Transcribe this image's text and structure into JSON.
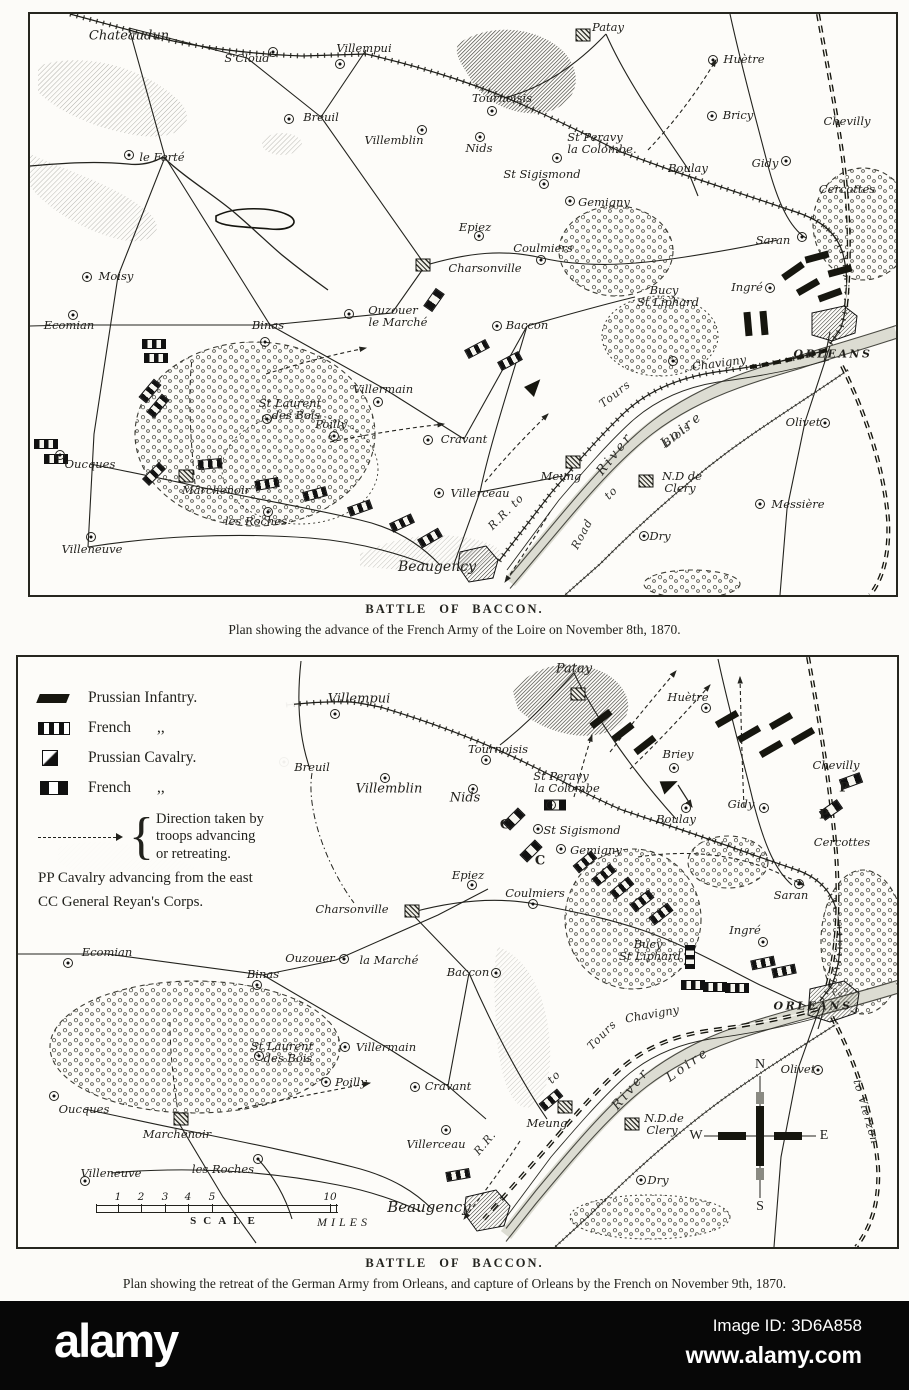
{
  "map1": {
    "caption_title": "BATTLE OF BACCON.",
    "caption_sub": "Plan showing the advance of the French Army of the Loire on November 8th, 1870.",
    "labels": [
      {
        "t": "Chateaudun",
        "x": 99,
        "y": 22,
        "s": 13
      },
      {
        "t": "S'Cloud",
        "x": 217,
        "y": 44,
        "d": [
          26,
          -6
        ]
      },
      {
        "t": "Villempui",
        "x": 334,
        "y": 34,
        "d": [
          -24,
          16
        ]
      },
      {
        "t": "Tournoisis",
        "x": 472,
        "y": 84,
        "d": [
          -10,
          13
        ]
      },
      {
        "t": "Breuil",
        "x": 291,
        "y": 103,
        "d": [
          -32,
          2
        ]
      },
      {
        "t": "Villemblin",
        "x": 364,
        "y": 126,
        "d": [
          28,
          -10
        ]
      },
      {
        "t": "Nids",
        "x": 449,
        "y": 134,
        "d": [
          1,
          -11
        ]
      },
      {
        "t": "St Peravy",
        "x": 565,
        "y": 123
      },
      {
        "t": "la Colombe.",
        "x": 572,
        "y": 135,
        "d": [
          -45,
          9
        ]
      },
      {
        "t": "St Sigismond",
        "x": 512,
        "y": 160,
        "d": [
          2,
          10
        ]
      },
      {
        "t": "Patay",
        "x": 578,
        "y": 13,
        "q": [
          -25,
          8
        ]
      },
      {
        "t": "Huètre",
        "x": 714,
        "y": 45,
        "d": [
          -31,
          1
        ]
      },
      {
        "t": "Bricy",
        "x": 708,
        "y": 101,
        "d": [
          -26,
          1
        ]
      },
      {
        "t": "Boulay",
        "x": 658,
        "y": 154
      },
      {
        "t": "Gidy",
        "x": 735,
        "y": 149,
        "d": [
          21,
          -2
        ]
      },
      {
        "t": "Chevilly",
        "x": 817,
        "y": 107
      },
      {
        "t": "Cercottes",
        "x": 817,
        "y": 175
      },
      {
        "t": "Saran",
        "x": 743,
        "y": 226,
        "d": [
          29,
          -3
        ]
      },
      {
        "t": "Ingré",
        "x": 717,
        "y": 273,
        "d": [
          23,
          1
        ]
      },
      {
        "t": "Gemigny",
        "x": 574,
        "y": 188,
        "d": [
          -34,
          -1
        ]
      },
      {
        "t": "Epiez",
        "x": 445,
        "y": 213,
        "d": [
          4,
          9
        ]
      },
      {
        "t": "Coulmiers",
        "x": 513,
        "y": 234,
        "d": [
          -2,
          12
        ]
      },
      {
        "t": "Charsonville",
        "x": 455,
        "y": 254,
        "q": [
          -62,
          -3
        ]
      },
      {
        "t": "Ouzouer",
        "x": 363,
        "y": 296
      },
      {
        "t": "le Marché",
        "x": 368,
        "y": 308,
        "d": [
          -49,
          -8
        ]
      },
      {
        "t": "Baccon",
        "x": 497,
        "y": 311,
        "d": [
          -30,
          1
        ]
      },
      {
        "t": "Bucy",
        "x": 634,
        "y": 276
      },
      {
        "t": "St Liphard",
        "x": 638,
        "y": 288
      },
      {
        "t": "Binas",
        "x": 238,
        "y": 311,
        "d": [
          -3,
          17
        ]
      },
      {
        "t": "Ecomian",
        "x": 39,
        "y": 311,
        "d": [
          4,
          -10
        ]
      },
      {
        "t": "Moisy",
        "x": 86,
        "y": 262,
        "d": [
          -29,
          1
        ]
      },
      {
        "t": "le Ferté",
        "x": 132,
        "y": 143,
        "d": [
          -33,
          -2
        ]
      },
      {
        "t": "Villermain",
        "x": 353,
        "y": 375,
        "d": [
          -5,
          13
        ]
      },
      {
        "t": "St Laurent",
        "x": 260,
        "y": 389
      },
      {
        "t": "des Bois",
        "x": 266,
        "y": 401,
        "d": [
          -29,
          4
        ]
      },
      {
        "t": "Poilly",
        "x": 301,
        "y": 410,
        "d": [
          3,
          12
        ]
      },
      {
        "t": "Cravant",
        "x": 434,
        "y": 425,
        "d": [
          -36,
          1
        ]
      },
      {
        "t": "Oucques",
        "x": 60,
        "y": 450,
        "d": [
          -30,
          -9
        ]
      },
      {
        "t": "Marchenoir",
        "x": 186,
        "y": 476,
        "q": [
          -30,
          -14
        ]
      },
      {
        "t": "les Roches",
        "x": 226,
        "y": 507,
        "d": [
          12,
          -9
        ]
      },
      {
        "t": "Villeneuve",
        "x": 62,
        "y": 535,
        "d": [
          -1,
          -12
        ]
      },
      {
        "t": "Beaugency",
        "x": 407,
        "y": 553,
        "s": 14
      },
      {
        "t": "Villerceau",
        "x": 450,
        "y": 479,
        "d": [
          -41,
          0
        ]
      },
      {
        "t": "Meung",
        "x": 531,
        "y": 462,
        "q": [
          12,
          -14
        ]
      },
      {
        "t": "N.D de",
        "x": 652,
        "y": 462,
        "q": [
          -36,
          5
        ]
      },
      {
        "t": "Clery",
        "x": 650,
        "y": 474
      },
      {
        "t": "Messière",
        "x": 768,
        "y": 490,
        "d": [
          -38,
          0
        ]
      },
      {
        "t": "Dry",
        "x": 630,
        "y": 522,
        "d": [
          -16,
          0
        ]
      },
      {
        "t": "Olivet",
        "x": 773,
        "y": 408,
        "d": [
          22,
          1
        ]
      },
      {
        "t": "ORLEANS",
        "x": 803,
        "y": 340,
        "c": "caps"
      },
      {
        "t": "Chavigny",
        "x": 689,
        "y": 349,
        "r": -8,
        "d": [
          -46,
          -2
        ]
      },
      {
        "t": "River",
        "x": 585,
        "y": 440,
        "r": -52,
        "c": "riv"
      },
      {
        "t": "Loire",
        "x": 652,
        "y": 416,
        "r": -38,
        "c": "riv"
      },
      {
        "t": "Tours",
        "x": 585,
        "y": 380,
        "r": -38,
        "c": "riv2"
      },
      {
        "t": "R.R. to",
        "x": 476,
        "y": 498,
        "r": -45,
        "c": "riv2"
      },
      {
        "t": "Road",
        "x": 552,
        "y": 520,
        "r": -62,
        "c": "riv2"
      },
      {
        "t": "to",
        "x": 581,
        "y": 479,
        "r": -45,
        "c": "riv2"
      },
      {
        "t": "Blois",
        "x": 647,
        "y": 421,
        "r": -38,
        "c": "riv2"
      }
    ],
    "units": [
      {
        "x": 787,
        "y": 243,
        "r": -15,
        "k": "pi"
      },
      {
        "x": 810,
        "y": 257,
        "r": -15,
        "k": "pi"
      },
      {
        "x": 763,
        "y": 257,
        "r": -35,
        "k": "pi"
      },
      {
        "x": 778,
        "y": 273,
        "r": -30,
        "k": "pi"
      },
      {
        "x": 800,
        "y": 281,
        "r": -20,
        "k": "pi"
      },
      {
        "x": 718,
        "y": 310,
        "r": 85,
        "k": "pi"
      },
      {
        "x": 734,
        "y": 309,
        "r": 85,
        "k": "pi"
      },
      {
        "x": 404,
        "y": 286,
        "r": -55,
        "k": "fc"
      },
      {
        "x": 447,
        "y": 335,
        "r": -28,
        "k": "fi"
      },
      {
        "x": 480,
        "y": 347,
        "r": -28,
        "k": "fi"
      },
      {
        "x": 505,
        "y": 372,
        "r": -45,
        "k": "pw"
      },
      {
        "x": 124,
        "y": 330,
        "r": 0,
        "k": "fi"
      },
      {
        "x": 126,
        "y": 344,
        "r": 0,
        "k": "fi"
      },
      {
        "x": 120,
        "y": 377,
        "r": -50,
        "k": "fi"
      },
      {
        "x": 128,
        "y": 392,
        "r": -50,
        "k": "fi"
      },
      {
        "x": 16,
        "y": 430,
        "r": 0,
        "k": "fi"
      },
      {
        "x": 26,
        "y": 445,
        "r": 0,
        "k": "fi"
      },
      {
        "x": 124,
        "y": 460,
        "r": -45,
        "k": "fi"
      },
      {
        "x": 180,
        "y": 450,
        "r": -5,
        "k": "fi"
      },
      {
        "x": 237,
        "y": 470,
        "r": -10,
        "k": "fi"
      },
      {
        "x": 285,
        "y": 480,
        "r": -15,
        "k": "fi"
      },
      {
        "x": 330,
        "y": 494,
        "r": -20,
        "k": "fi"
      },
      {
        "x": 372,
        "y": 509,
        "r": -25,
        "k": "fi"
      },
      {
        "x": 400,
        "y": 524,
        "r": -30,
        "k": "fi"
      }
    ]
  },
  "map2": {
    "caption_title": "BATTLE OF BACCON.",
    "caption_sub": "Plan showing the retreat of the German Army from Orleans, and capture of Orleans by the French on November 9th, 1870.",
    "legend": {
      "items": [
        {
          "label": "Prussian Infantry."
        },
        {
          "label": "French",
          "ditto": ",,"
        },
        {
          "label": "Prussian Cavalry."
        },
        {
          "label": "French",
          "ditto": ",,"
        }
      ],
      "direction_lines": [
        "Direction taken by",
        "troops advancing",
        "or retreating."
      ],
      "pp_note": "PP Cavalry advancing from the east",
      "cc_note": "CC General Reyan's Corps."
    },
    "scale": {
      "ticks": [
        {
          "t": "1",
          "x": 22
        },
        {
          "t": "2",
          "x": 45
        },
        {
          "t": "3",
          "x": 69
        },
        {
          "t": "4",
          "x": 92
        },
        {
          "t": "5",
          "x": 116
        },
        {
          "t": "10",
          "x": 234
        }
      ],
      "label": "SCALE",
      "units": "MILES"
    },
    "compass": {
      "n": "N",
      "e": "E",
      "s": "S",
      "w": "W"
    },
    "labels": [
      {
        "t": "Villempui",
        "x": 341,
        "y": 42,
        "s": 13,
        "d": [
          -24,
          15
        ]
      },
      {
        "t": "Patay",
        "x": 556,
        "y": 12,
        "s": 13,
        "q": [
          4,
          25
        ]
      },
      {
        "t": "Tournoisis",
        "x": 480,
        "y": 92,
        "d": [
          -12,
          11
        ]
      },
      {
        "t": "Breuil",
        "x": 294,
        "y": 110,
        "d": [
          -28,
          -5
        ]
      },
      {
        "t": "Villemblin",
        "x": 371,
        "y": 132,
        "s": 13,
        "d": [
          -4,
          -11
        ]
      },
      {
        "t": "Nids",
        "x": 447,
        "y": 141,
        "s": 13,
        "d": [
          8,
          -9
        ]
      },
      {
        "t": "St Peravy",
        "x": 543,
        "y": 119
      },
      {
        "t": "la Colombe",
        "x": 549,
        "y": 131,
        "d": [
          -16,
          17
        ]
      },
      {
        "t": "St Sigismond",
        "x": 564,
        "y": 173,
        "d": [
          -44,
          -1
        ]
      },
      {
        "t": "C",
        "x": 487,
        "y": 168,
        "c": "unitl"
      },
      {
        "t": "C",
        "x": 522,
        "y": 204,
        "c": "unitl"
      },
      {
        "t": "Gemigny",
        "x": 578,
        "y": 193,
        "d": [
          -35,
          -1
        ]
      },
      {
        "t": "Epiez",
        "x": 450,
        "y": 218,
        "d": [
          4,
          10
        ]
      },
      {
        "t": "Coulmiers",
        "x": 517,
        "y": 236,
        "d": [
          -2,
          11
        ]
      },
      {
        "t": "Charsonville",
        "x": 334,
        "y": 252,
        "q": [
          60,
          2
        ]
      },
      {
        "t": "Boulay",
        "x": 658,
        "y": 162,
        "d": [
          10,
          -11
        ]
      },
      {
        "t": "Huètre",
        "x": 670,
        "y": 40,
        "d": [
          18,
          11
        ]
      },
      {
        "t": "Briey",
        "x": 660,
        "y": 97,
        "d": [
          -4,
          14
        ]
      },
      {
        "t": "Gidy",
        "x": 723,
        "y": 147,
        "d": [
          23,
          4
        ]
      },
      {
        "t": "Chevilly",
        "x": 818,
        "y": 108
      },
      {
        "t": "P",
        "x": 826,
        "y": 131,
        "c": "unitl"
      },
      {
        "t": "P",
        "x": 806,
        "y": 158,
        "c": "unitl"
      },
      {
        "t": "Cercottes",
        "x": 824,
        "y": 185
      },
      {
        "t": "Saran",
        "x": 773,
        "y": 238,
        "d": [
          8,
          -11
        ]
      },
      {
        "t": "Ingré",
        "x": 727,
        "y": 273,
        "d": [
          18,
          12
        ]
      },
      {
        "t": "Bucy",
        "x": 630,
        "y": 287
      },
      {
        "t": "St Liphard",
        "x": 632,
        "y": 299
      },
      {
        "t": "Baccon",
        "x": 450,
        "y": 315,
        "d": [
          28,
          1
        ]
      },
      {
        "t": "ORLEANS",
        "x": 795,
        "y": 349,
        "c": "caps"
      },
      {
        "t": "Chavigny",
        "x": 634,
        "y": 357,
        "r": -10
      },
      {
        "t": "Olivet",
        "x": 780,
        "y": 412,
        "d": [
          20,
          1
        ]
      },
      {
        "t": "River",
        "x": 613,
        "y": 432,
        "r": -50,
        "c": "riv"
      },
      {
        "t": "Loire",
        "x": 670,
        "y": 408,
        "r": -35,
        "c": "riv"
      },
      {
        "t": "Tours",
        "x": 584,
        "y": 378,
        "r": -45,
        "c": "riv2"
      },
      {
        "t": "to",
        "x": 536,
        "y": 420,
        "r": -45,
        "c": "riv2"
      },
      {
        "t": "R.R.",
        "x": 467,
        "y": 486,
        "r": -50,
        "c": "riv2"
      },
      {
        "t": "Meung",
        "x": 529,
        "y": 466,
        "q": [
          18,
          -16
        ]
      },
      {
        "t": "N.D.de",
        "x": 646,
        "y": 461,
        "q": [
          -32,
          6
        ]
      },
      {
        "t": "Clery",
        "x": 644,
        "y": 473
      },
      {
        "t": "Dry",
        "x": 640,
        "y": 523,
        "d": [
          -17,
          0
        ]
      },
      {
        "t": "Cravant",
        "x": 430,
        "y": 429,
        "d": [
          -33,
          1
        ]
      },
      {
        "t": "Villermain",
        "x": 368,
        "y": 390,
        "d": [
          -41,
          0
        ]
      },
      {
        "t": "St Laurent",
        "x": 264,
        "y": 389
      },
      {
        "t": "des Bois",
        "x": 270,
        "y": 401,
        "d": [
          -29,
          -2
        ]
      },
      {
        "t": "Poilly",
        "x": 333,
        "y": 425,
        "d": [
          -25,
          0
        ]
      },
      {
        "t": "Binas",
        "x": 245,
        "y": 317,
        "d": [
          -6,
          11
        ]
      },
      {
        "t": "Ouzouer",
        "x": 292,
        "y": 301,
        "d": [
          34,
          1
        ]
      },
      {
        "t": "la Marché",
        "x": 371,
        "y": 303
      },
      {
        "t": "Ecomian",
        "x": 89,
        "y": 295,
        "d": [
          -39,
          11
        ]
      },
      {
        "t": "Oucques",
        "x": 66,
        "y": 452,
        "d": [
          -30,
          -13
        ]
      },
      {
        "t": "Marchenoir",
        "x": 159,
        "y": 477,
        "q": [
          4,
          -15
        ]
      },
      {
        "t": "les Roches",
        "x": 205,
        "y": 512,
        "d": [
          35,
          -10
        ]
      },
      {
        "t": "Villeneuve",
        "x": 93,
        "y": 516,
        "d": [
          -26,
          8
        ]
      },
      {
        "t": "Beaugency",
        "x": 411,
        "y": 550,
        "s": 15
      },
      {
        "t": "Villerceau",
        "x": 418,
        "y": 487,
        "d": [
          10,
          -14
        ]
      },
      {
        "t": "to Vierzon",
        "x": 848,
        "y": 455,
        "r": 74,
        "c": "riv2"
      }
    ],
    "units": [
      {
        "x": 583,
        "y": 62,
        "r": -38,
        "k": "pi"
      },
      {
        "x": 605,
        "y": 75,
        "r": -38,
        "k": "pi"
      },
      {
        "x": 627,
        "y": 88,
        "r": -38,
        "k": "pi"
      },
      {
        "x": 709,
        "y": 62,
        "r": -30,
        "k": "pi"
      },
      {
        "x": 731,
        "y": 77,
        "r": -30,
        "k": "pi"
      },
      {
        "x": 753,
        "y": 92,
        "r": -30,
        "k": "pi"
      },
      {
        "x": 763,
        "y": 64,
        "r": -30,
        "k": "pi"
      },
      {
        "x": 785,
        "y": 79,
        "r": -30,
        "k": "pi"
      },
      {
        "x": 652,
        "y": 128,
        "r": -20,
        "k": "pw"
      },
      {
        "x": 537,
        "y": 148,
        "r": 0,
        "k": "fc"
      },
      {
        "x": 496,
        "y": 162,
        "r": -45,
        "k": "fc"
      },
      {
        "x": 513,
        "y": 194,
        "r": -45,
        "k": "fc"
      },
      {
        "x": 833,
        "y": 124,
        "r": -20,
        "k": "fc"
      },
      {
        "x": 813,
        "y": 153,
        "r": -35,
        "k": "fc"
      },
      {
        "x": 567,
        "y": 205,
        "r": -40,
        "k": "fi"
      },
      {
        "x": 586,
        "y": 218,
        "r": -40,
        "k": "fi"
      },
      {
        "x": 604,
        "y": 231,
        "r": -40,
        "k": "fi"
      },
      {
        "x": 624,
        "y": 244,
        "r": -38,
        "k": "fi"
      },
      {
        "x": 643,
        "y": 257,
        "r": -38,
        "k": "fi"
      },
      {
        "x": 675,
        "y": 328,
        "r": 0,
        "k": "fi"
      },
      {
        "x": 697,
        "y": 330,
        "r": 0,
        "k": "fi"
      },
      {
        "x": 719,
        "y": 331,
        "r": 0,
        "k": "fi"
      },
      {
        "x": 745,
        "y": 306,
        "r": -12,
        "k": "fi"
      },
      {
        "x": 766,
        "y": 314,
        "r": -12,
        "k": "fi"
      },
      {
        "x": 672,
        "y": 300,
        "r": 90,
        "k": "fi"
      },
      {
        "x": 533,
        "y": 443,
        "r": -40,
        "k": "fi"
      },
      {
        "x": 440,
        "y": 518,
        "r": -10,
        "k": "fi"
      }
    ]
  },
  "footer": {
    "brand": "alamy",
    "image_id": "Image ID: 3D6A858",
    "url": "www.alamy.com"
  }
}
